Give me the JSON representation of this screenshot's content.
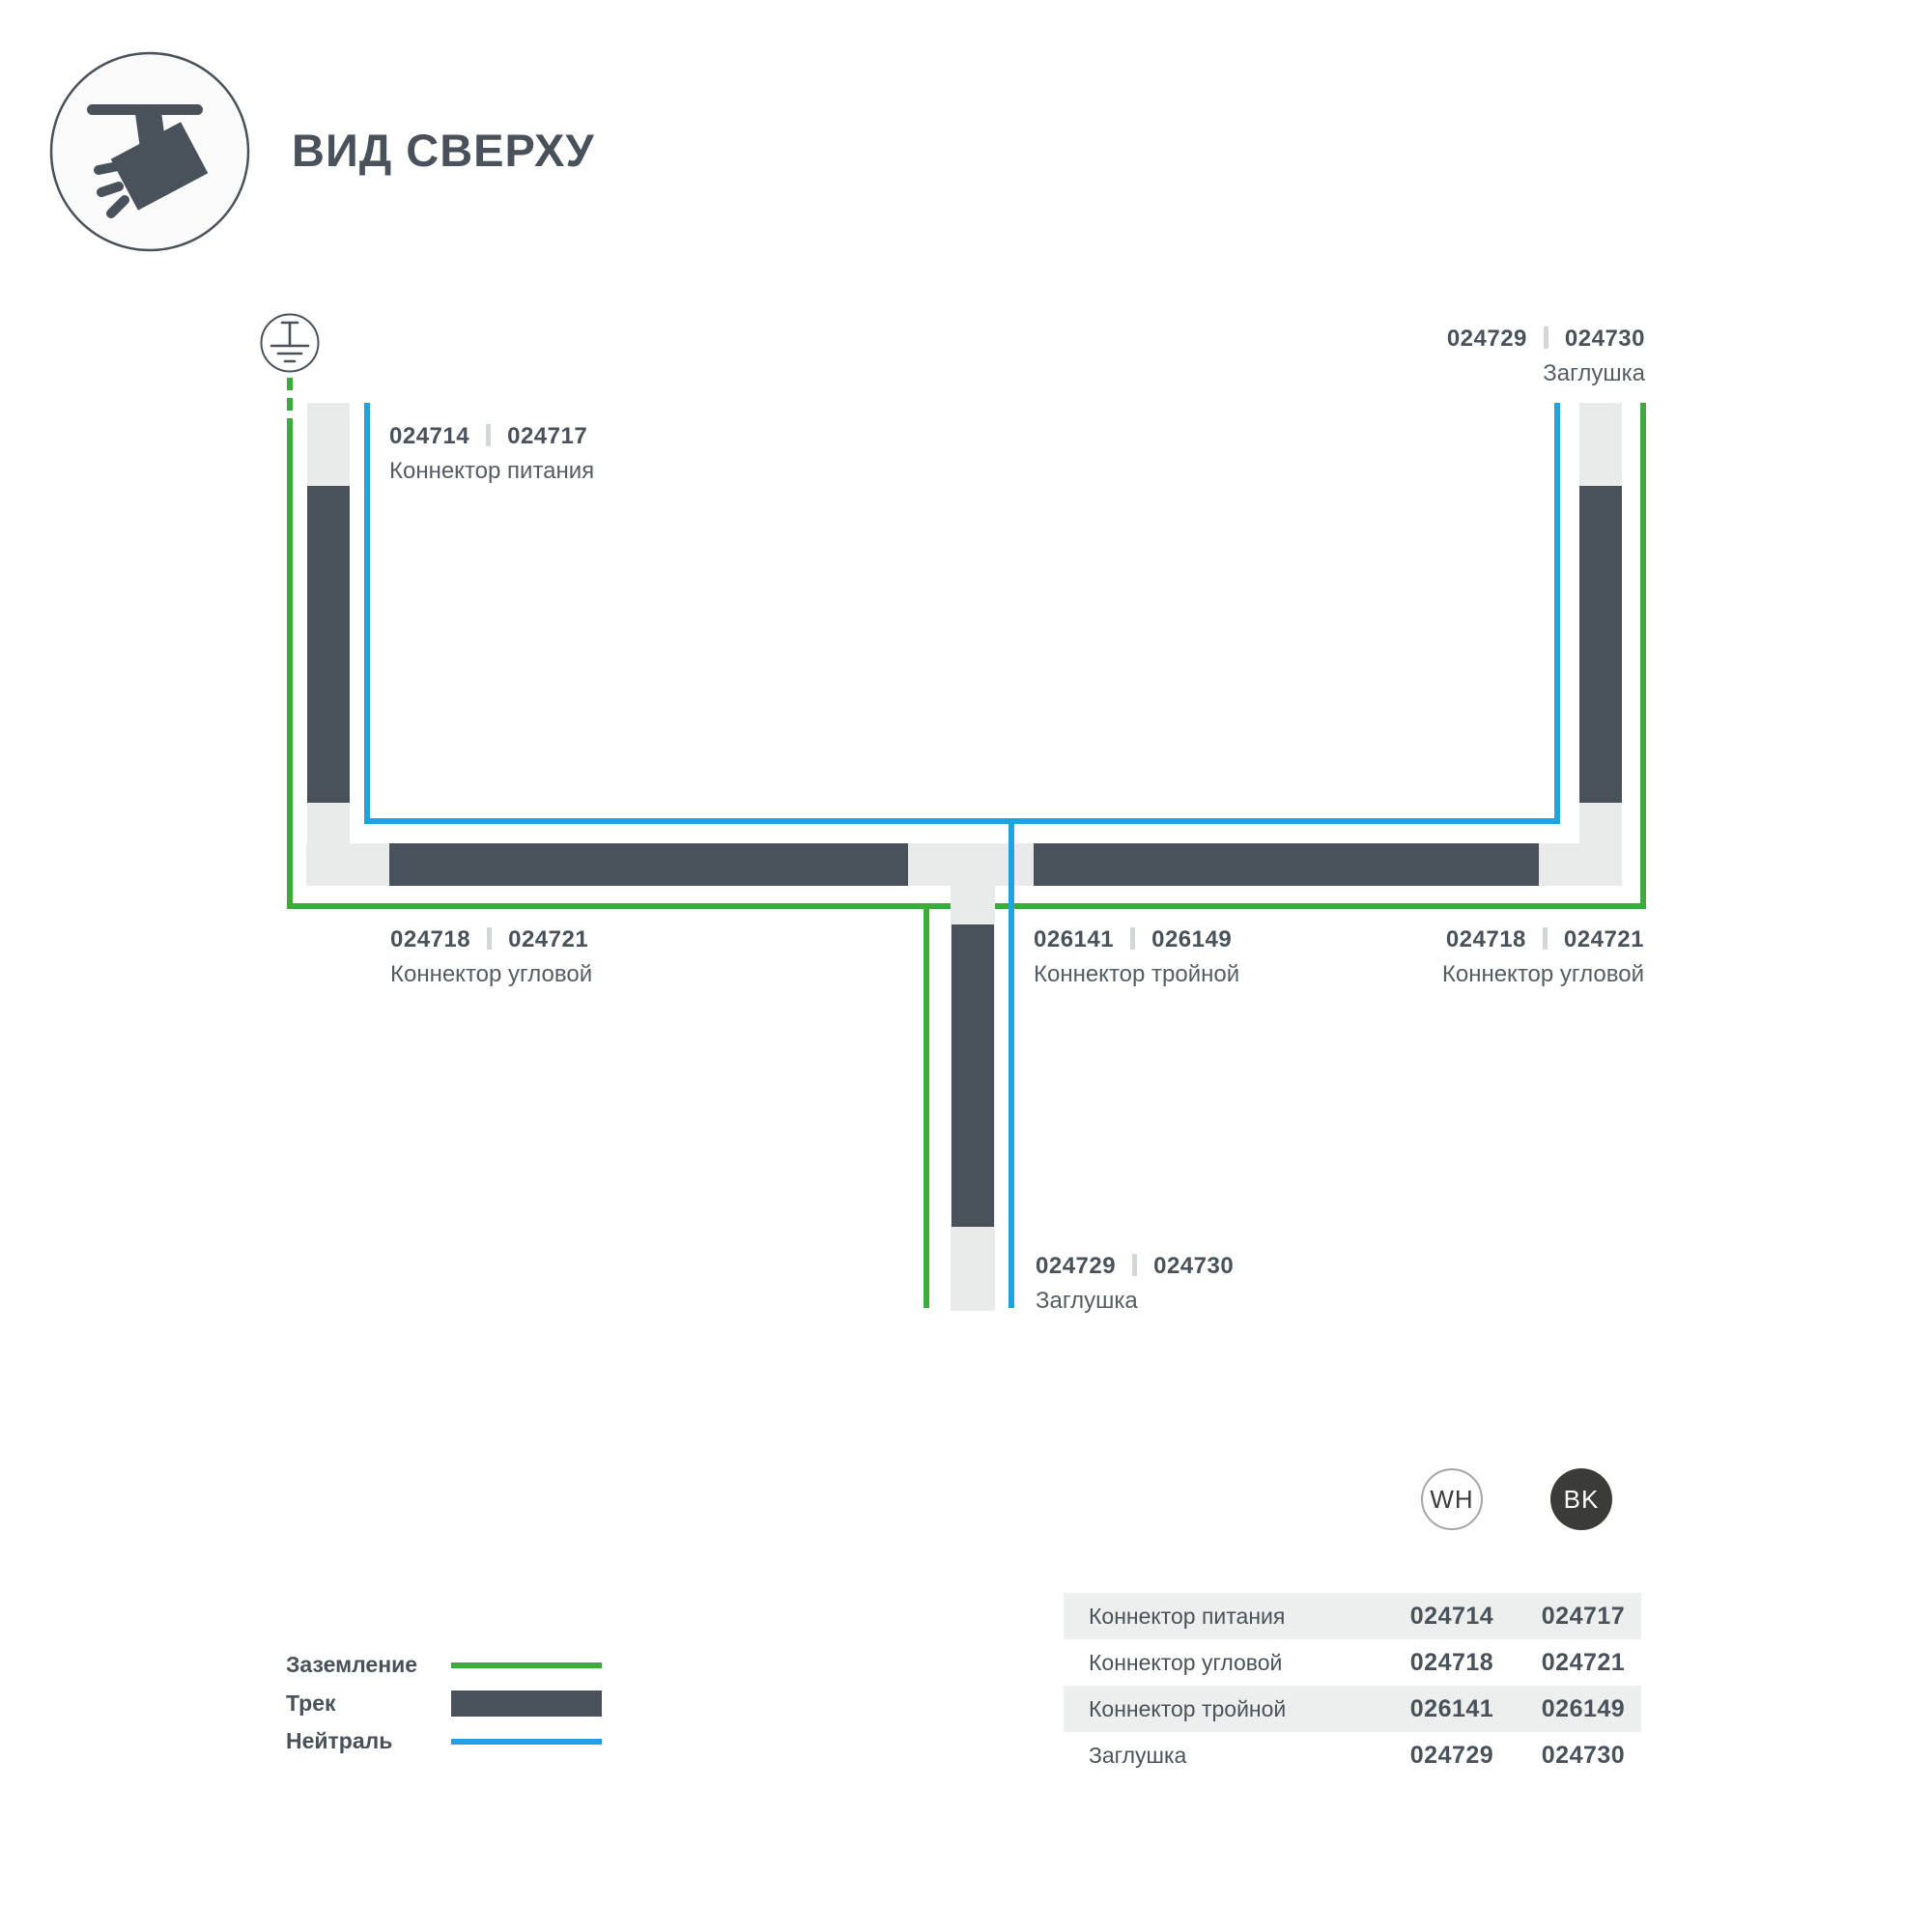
{
  "header": {
    "title": "ВИД СВЕРХУ"
  },
  "diagram": {
    "labels": {
      "power": {
        "num_wh": "024714",
        "num_bk": "024717",
        "caption": "Коннектор питания"
      },
      "cap_top_right": {
        "num_wh": "024729",
        "num_bk": "024730",
        "caption": "Заглушка"
      },
      "corner_left": {
        "num_wh": "024718",
        "num_bk": "024721",
        "caption": "Коннектор угловой"
      },
      "tee": {
        "num_wh": "026141",
        "num_bk": "026149",
        "caption": "Коннектор тройной"
      },
      "corner_right": {
        "num_wh": "024718",
        "num_bk": "024721",
        "caption": "Коннектор угловой"
      },
      "cap_bottom": {
        "num_wh": "024729",
        "num_bk": "024730",
        "caption": "Заглушка"
      }
    }
  },
  "legend": {
    "items": [
      {
        "label": "Заземление",
        "type": "ground-line"
      },
      {
        "label": "Трек",
        "type": "track-bar"
      },
      {
        "label": "Нейтраль",
        "type": "neutral-line"
      }
    ]
  },
  "variants": {
    "wh": "WH",
    "bk": "BK"
  },
  "table": {
    "rows": [
      {
        "name": "Коннектор питания",
        "wh": "024714",
        "bk": "024717"
      },
      {
        "name": "Коннектор угловой",
        "wh": "024718",
        "bk": "024721"
      },
      {
        "name": "Коннектор тройной",
        "wh": "026141",
        "bk": "026149"
      },
      {
        "name": "Заглушка",
        "wh": "024729",
        "bk": "024730"
      }
    ]
  },
  "colors": {
    "track_dark": "#49525A",
    "track_light": "#E9EAEA",
    "ground_green": "#3FAA3C",
    "neutral_blue": "#1EA3DC",
    "row_gray": "#EDEEEE",
    "separator_gray": "#D4D7D8",
    "bk_circle": "#3B3C3A"
  }
}
